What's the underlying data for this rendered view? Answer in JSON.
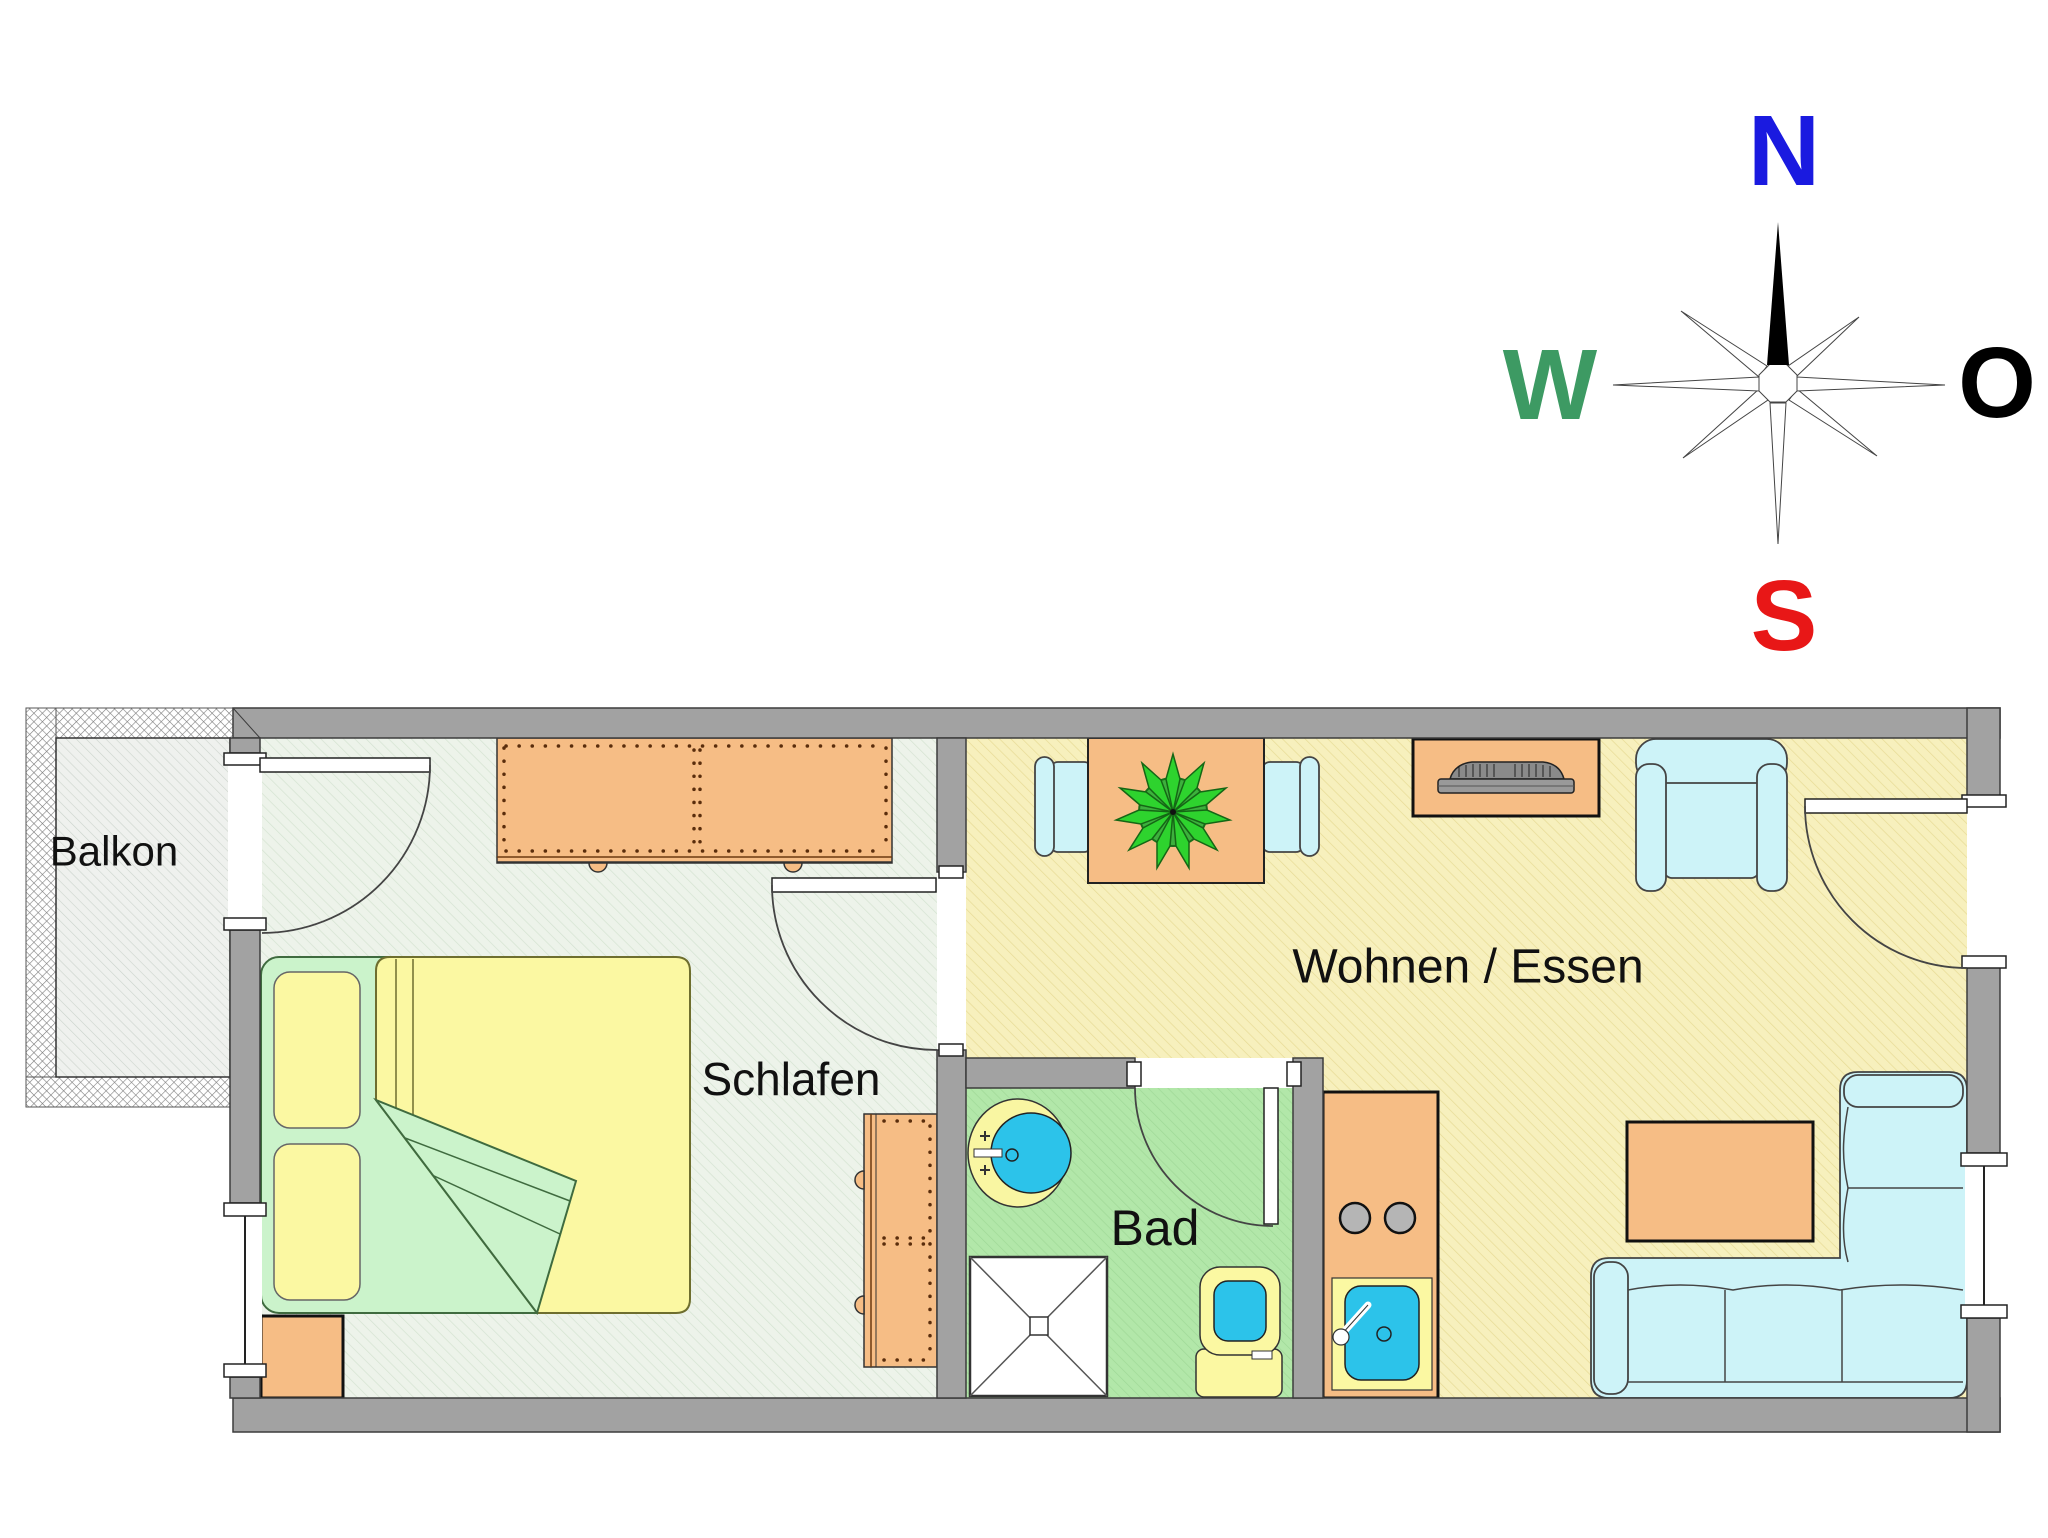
{
  "compass": {
    "north": "N",
    "east": "O",
    "south": "S",
    "west": "W"
  },
  "rooms": {
    "balcony": "Balkon",
    "bedroom": "Schlafen",
    "bathroom": "Bad",
    "living_dining": "Wohnen / Essen"
  },
  "colors": {
    "wall": "#a2a2a2",
    "wall_edge": "#3c3c3c",
    "bedroom_floor": "#edf3ea",
    "bedroom_hatch": "#d4e3d1",
    "living_floor": "#f7f0bd",
    "living_hatch": "#e7db95",
    "bath_floor": "#b2e7a9",
    "bath_hatch": "#9ed896",
    "balcony_floor": "#eff1ee",
    "balcony_hatch": "#cbd3cb",
    "crosshatch": "#7d7d7d",
    "furniture_orange": "#f6bd85",
    "upholstery_cyan": "#cdf3f8",
    "bedding_yellow": "#fbf8a2",
    "blanket_mint": "#cbf3cb",
    "water_blue": "#2cc3ea",
    "hotplate_gray": "#b5b5b5",
    "tv_gray": "#8a8a8a",
    "plant_green": "#2ed32e",
    "plant_pot_green": "#3db03d",
    "compass_north": "#1a1ae0",
    "compass_east": "#000000",
    "compass_south": "#e81717",
    "compass_west": "#3d9a63",
    "label_text": "#111111"
  }
}
